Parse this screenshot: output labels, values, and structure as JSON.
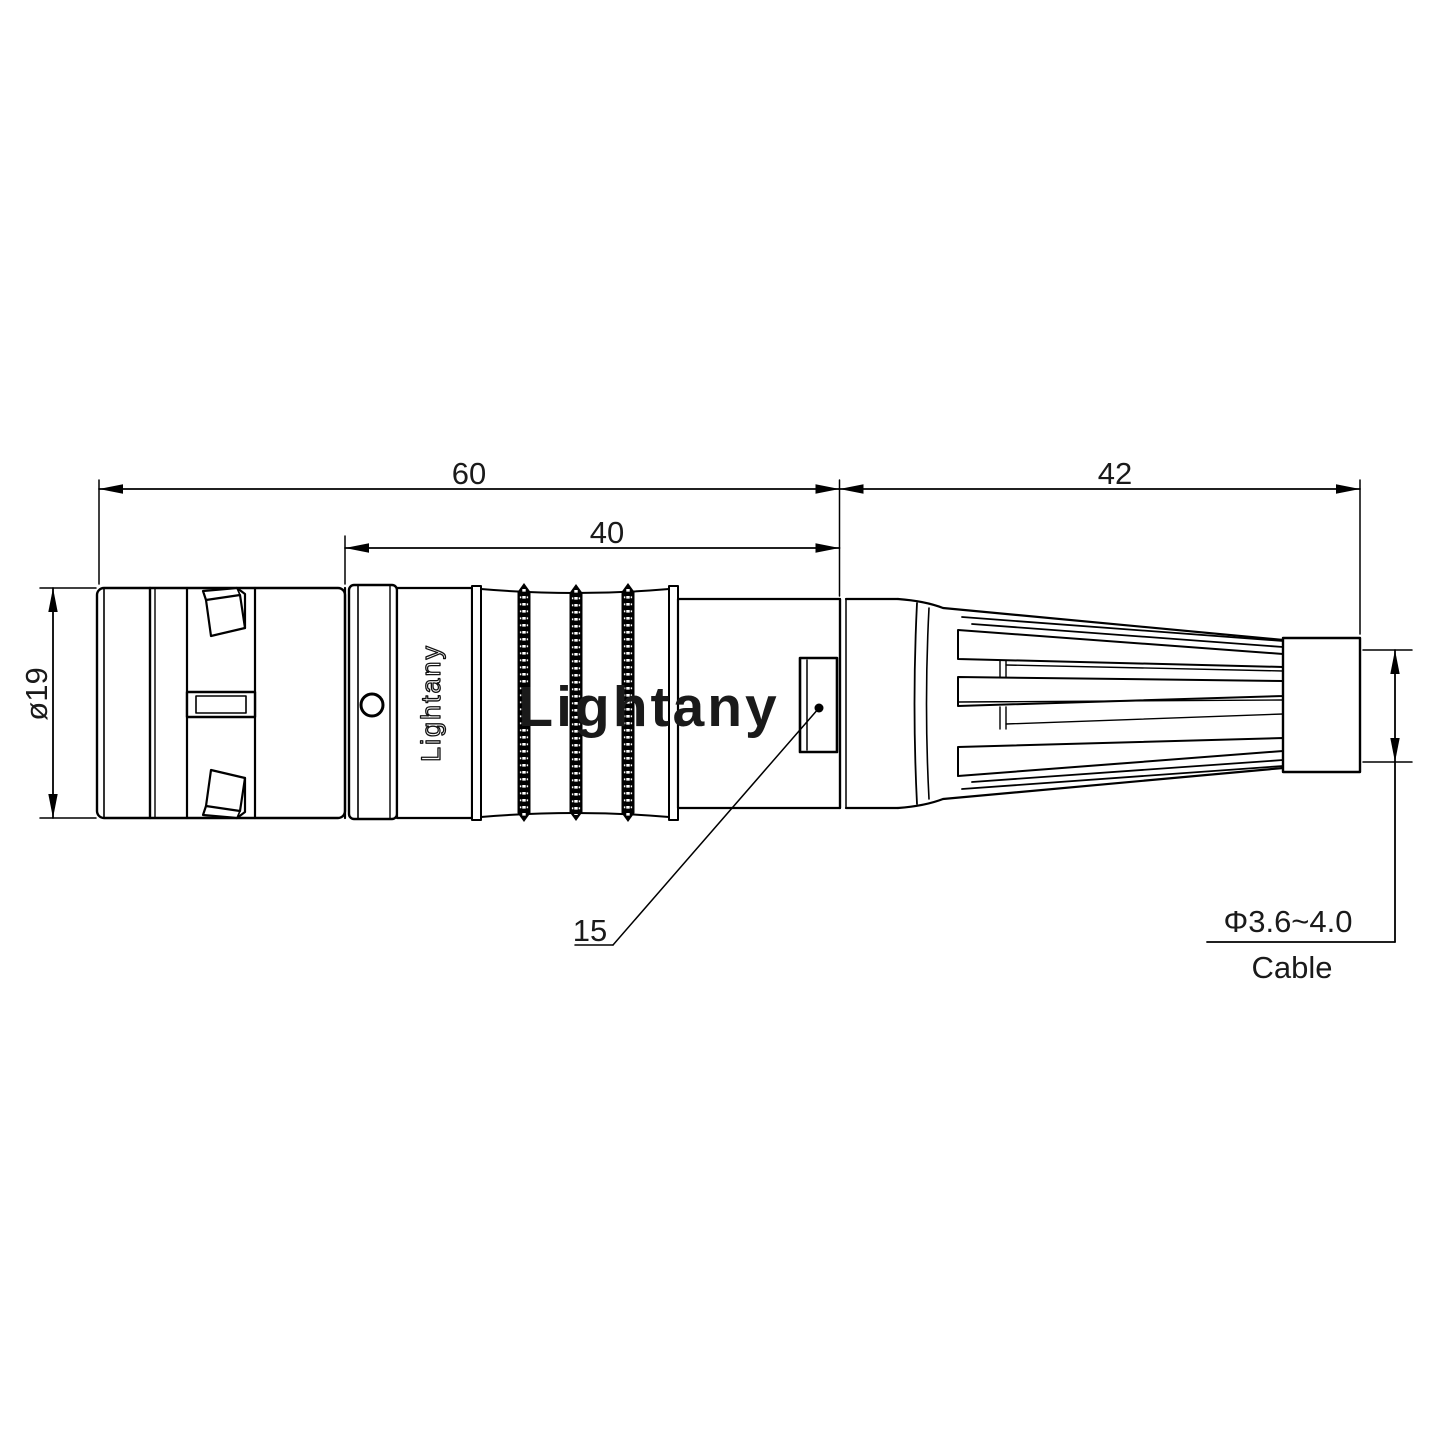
{
  "labels": {
    "dim_total_length": "60",
    "dim_grip_length": "40",
    "dim_boot_length": "42",
    "dim_body_diameter": "ø19",
    "dim_nut_feature": "15",
    "dim_cable_range": "Φ3.6~4.0",
    "dim_cable_caption": "Cable"
  },
  "branding": {
    "body_text": "Lightany",
    "watermark_text": "Lightany"
  },
  "colors": {
    "line": "#000000",
    "dim_text": "#1a1a1a",
    "watermark": "rgba(213,40,40,0.25)"
  }
}
